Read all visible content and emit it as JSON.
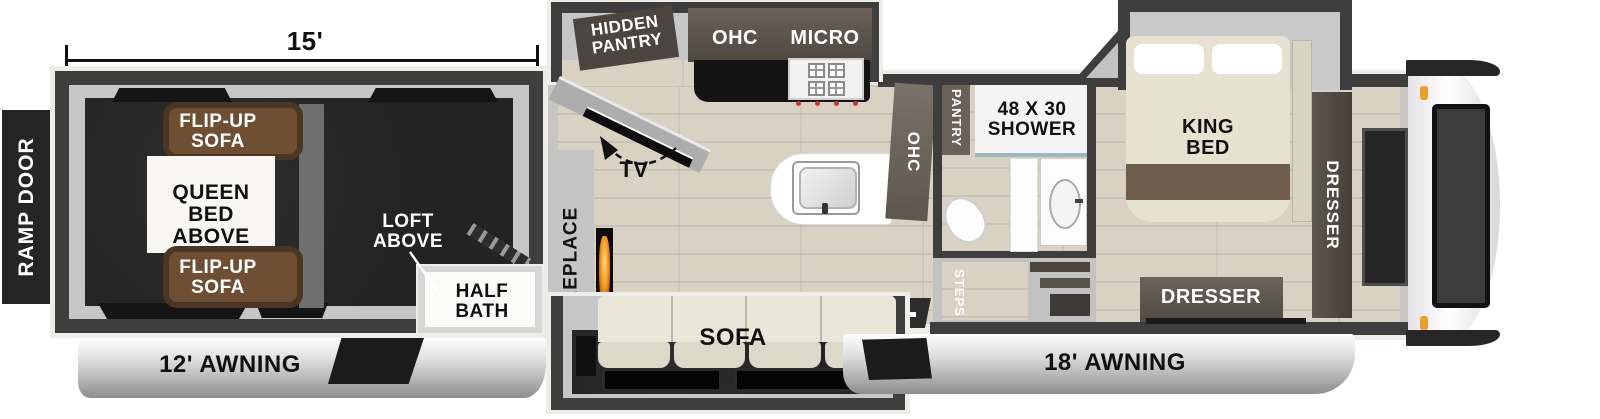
{
  "dimension": {
    "garage_length": "15'"
  },
  "ramp_door_label": "RAMP DOOR",
  "garage": {
    "flip_up_sofa_top": "FLIP-UP SOFA",
    "queen_bed_above": "QUEEN BED ABOVE",
    "flip_up_sofa_bottom": "FLIP-UP SOFA",
    "loft_above": "LOFT ABOVE",
    "half_bath": "HALF BATH",
    "awning": "12' AWNING"
  },
  "kitchen": {
    "hidden_pantry": "HIDDEN PANTRY",
    "ohc": "OHC",
    "micro": "MICRO",
    "tv": "TV",
    "fireplace": "FIREPLACE",
    "sofa": "SOFA",
    "counter_ohc": "OHC"
  },
  "bathroom": {
    "pantry": "PANTRY",
    "shower": "48 X 30 SHOWER",
    "steps": "STEPS"
  },
  "bedroom": {
    "king_bed": "KING BED",
    "dresser_foot": "DRESSER",
    "dresser_side": "DRESSER",
    "awning": "18' AWNING"
  },
  "colors": {
    "wall": "#3e3e3e",
    "sofa_brown": "#6e4f34",
    "flame_orange": "#f59a23",
    "marker_light": "#ef9d2a"
  }
}
